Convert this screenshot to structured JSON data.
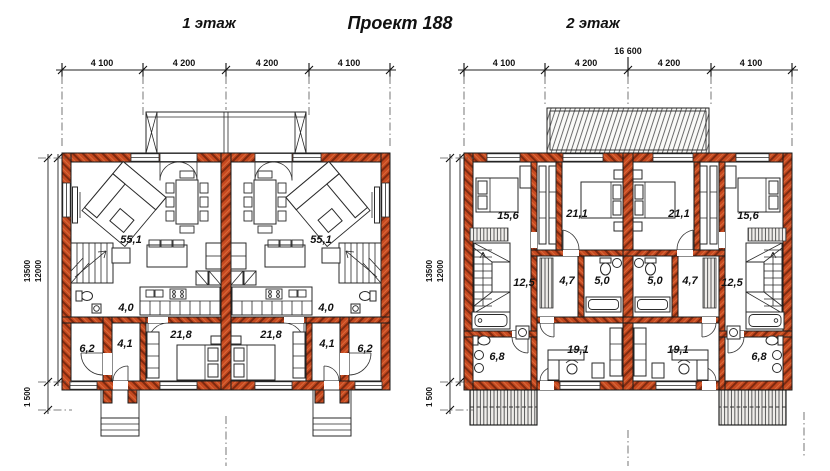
{
  "header": {
    "floor1_label": "1 этаж",
    "project_title": "Проект 188",
    "floor2_label": "2 этаж"
  },
  "colors": {
    "wall_fill": "#c6491f",
    "wall_hatch": "#7e2a10",
    "outline": "#1a1a1a"
  },
  "floor1": {
    "dims_top": [
      "4 100",
      "4 200",
      "4 200",
      "4 100"
    ],
    "height_total": "13500",
    "height_main": "12000",
    "porch_depth": "1 500",
    "rooms": {
      "living": "55,1",
      "kitchen": "4,0",
      "bedroom": "21,8",
      "bathroom": "6,2",
      "hall": "4,1"
    }
  },
  "floor2": {
    "width_total": "16 600",
    "dims_top": [
      "4 100",
      "4 200",
      "4 200",
      "4 100"
    ],
    "height_total": "13500",
    "height_main": "12000",
    "porch_depth": "1 500",
    "rooms": {
      "bedroom_small": "15,6",
      "bedroom_large": "21,1",
      "hall": "12,5",
      "wardrobe": "4,7",
      "bathroom": "5,0",
      "bathroom_lower": "6,8",
      "study": "19,1"
    }
  }
}
